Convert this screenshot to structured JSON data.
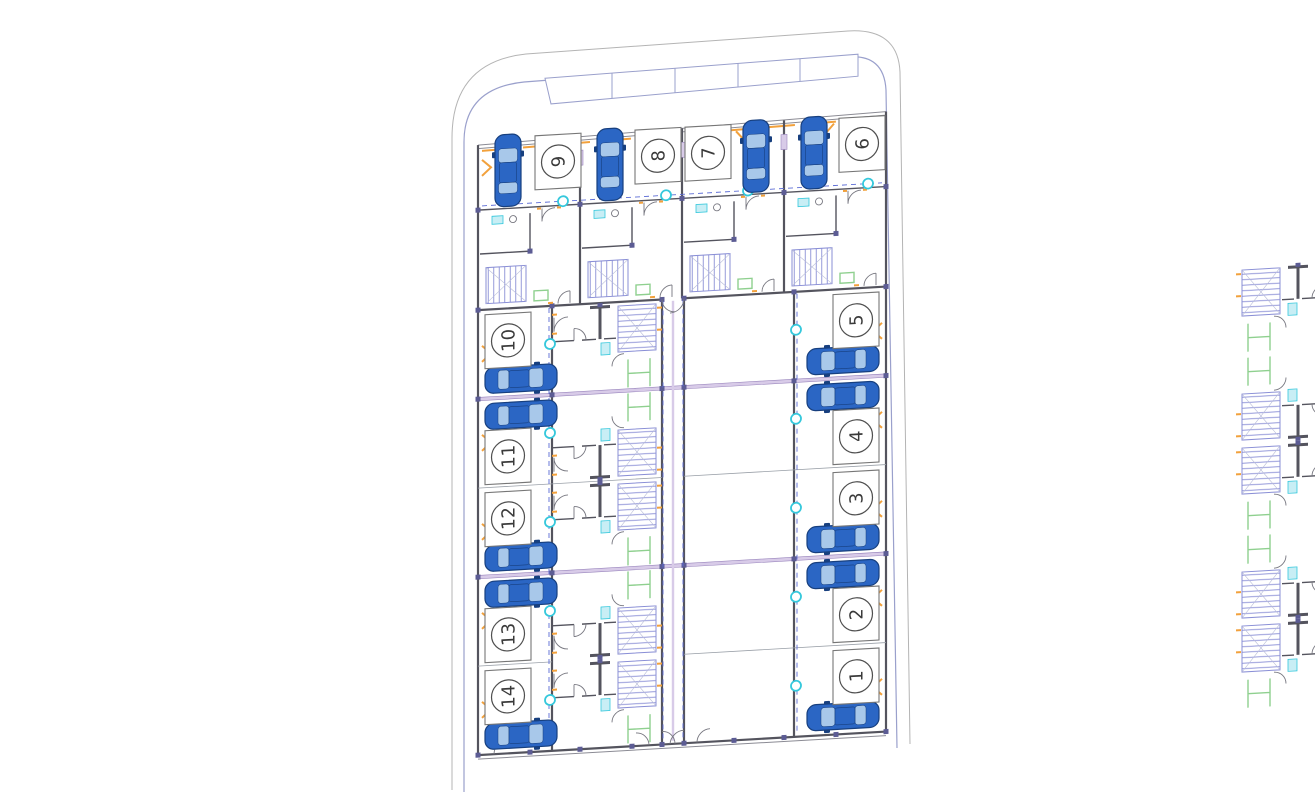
{
  "plots": {
    "top_row": [
      {
        "label": "9"
      },
      {
        "label": "8"
      },
      {
        "label": "7"
      },
      {
        "label": "6"
      }
    ],
    "left_column": [
      {
        "label": "10"
      },
      {
        "label": "11"
      },
      {
        "label": "12"
      },
      {
        "label": "13"
      },
      {
        "label": "14"
      }
    ],
    "right_column": [
      {
        "label": "5"
      },
      {
        "label": "4"
      },
      {
        "label": "3"
      },
      {
        "label": "2"
      },
      {
        "label": "1"
      }
    ]
  },
  "icons": {
    "car": "top-view-car-icon",
    "stairs": "stair-flight-hatch",
    "entry": "orange-chevron-entry-mark"
  },
  "colors": {
    "wall": "#54545e",
    "wall-light": "#8b8b94",
    "thin-line": "#9aa0a8",
    "orange": "#f2a13c",
    "purple": "#9a86bd",
    "purple-light": "#d8cbe8",
    "purple-dark": "#5c5c94",
    "green": "#8fd08f",
    "cyan": "#35c8dc",
    "cyan-light": "#c8eef5",
    "stair-blue": "#8a8fd6",
    "dash-blue": "#5b6bd5",
    "car-body": "#2b66c4",
    "car-dark": "#173f7e",
    "car-window": "#a8c8ea",
    "boundary-inner": "#9aa0cc",
    "boundary-outer": "#b4b4b4"
  }
}
